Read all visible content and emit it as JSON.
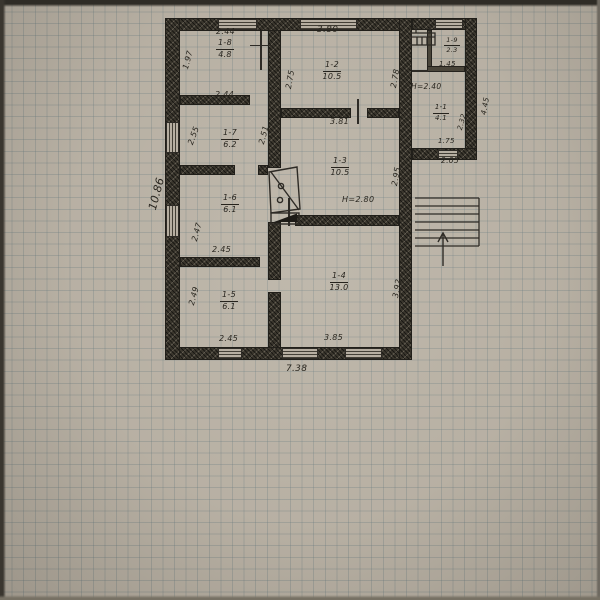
{
  "colors": {
    "paper": "#b4ac9f",
    "ink": "#2e2b26",
    "wall_fill": "#3a362d",
    "grid_line": "#607378"
  },
  "rooms": [
    {
      "id": "1-8",
      "area": "4.8"
    },
    {
      "id": "1-2",
      "area": "10.5"
    },
    {
      "id": "1-7",
      "area": "6.2"
    },
    {
      "id": "1-3",
      "area": "10.5"
    },
    {
      "id": "1-6",
      "area": "6.1"
    },
    {
      "id": "1-5",
      "area": "6.1"
    },
    {
      "id": "1-4",
      "area": "13.0"
    },
    {
      "id": "1-9",
      "area": "2.3"
    },
    {
      "id": "1-1",
      "area": "4.1"
    }
  ],
  "dimensions": {
    "room_1_8_width": "2.44",
    "room_1_8_depth": "1.97",
    "room_1_2_width": "3.80",
    "room_1_2_depth_left": "2.75",
    "room_1_2_depth_right": "2.78",
    "room_1_7_width": "2.44",
    "room_1_7_depth_left": "2.55",
    "room_1_7_depth_right": "2.51",
    "room_1_3_width": "3.81",
    "room_1_3_depth": "2.95",
    "room_1_6_depth": "2.47",
    "room_1_6_width": "2.45",
    "room_1_5_depth": "2.49",
    "room_1_5_width": "2.45",
    "room_1_4_width": "3.85",
    "room_1_4_depth": "3.92",
    "room_1_9_depth": "1.42",
    "room_1_9_width": "1.45",
    "room_1_1_depth": "2.32",
    "room_1_1_width": "1.75",
    "annex_width": "2.05",
    "annex_depth": "4.45",
    "house_width": "7.38",
    "house_depth": "10.86"
  },
  "ceiling_heights": {
    "main": "H=2.80",
    "annex": "H=2.40"
  },
  "symbols": {
    "stairs": "stairs-up-arrow",
    "stove": "corner-stove",
    "vent": "chimney-vent",
    "door_mark": "door-opening-tick"
  }
}
